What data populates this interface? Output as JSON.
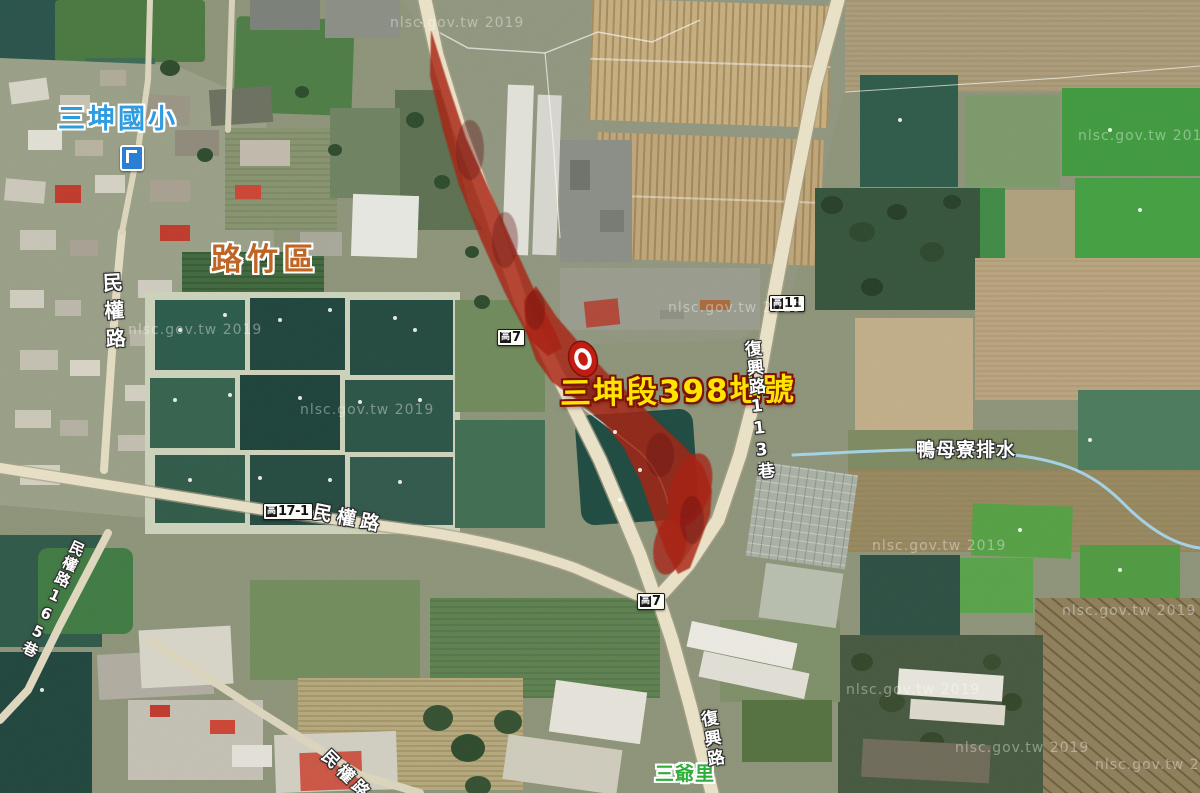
{
  "map": {
    "attribution_watermark": "nlsc.gov.tw 2019",
    "labels": {
      "school": "三坤國小",
      "district": "路竹區",
      "parcel": "三坤段398地號",
      "canal": "鴨母寮排水",
      "village": "三爺里",
      "road_minquan": "民權路",
      "road_minquan_lane165": "民權路165巷",
      "road_fuxing_lane113": "復興路113巷",
      "road_fuxing": "復興路"
    },
    "road_badges": [
      {
        "prefix": "高",
        "number": "7"
      },
      {
        "prefix": "高",
        "number": "11"
      },
      {
        "prefix": "高",
        "number": "17-1"
      },
      {
        "prefix": "高",
        "number": "7"
      }
    ],
    "colors": {
      "parcel_highlight": "#a81d10",
      "parcel_label_text": "#ffe400",
      "parcel_label_outline": "#7c1206",
      "district_label_text": "#bf6526",
      "school_label_text": "#2e9ce0",
      "village_label_text": "#2fae3a",
      "road_fill": "#ebe3c8",
      "canal_line": "#a5d6ef",
      "marker_red": "#c3170c"
    }
  }
}
